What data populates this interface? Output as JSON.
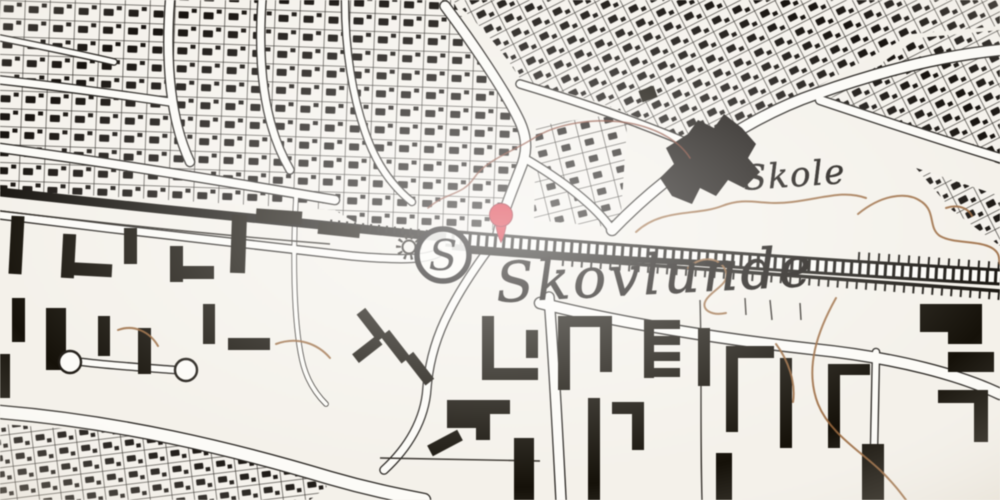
{
  "map": {
    "labels": {
      "place": "Skovlunde",
      "school": "Skole",
      "station": "S"
    },
    "marker": {
      "x": 500,
      "y": 216,
      "shape": "pin"
    },
    "station_symbol": {
      "x": 443,
      "y": 255
    },
    "colors": {
      "paper": "#f4f1ea",
      "ink": "#17130f",
      "road": "#fcfbf7",
      "contour": "#96673f",
      "contour_dark": "#7c3b2b",
      "marker_red": "#d1202e",
      "marker_edge": "#8c1420"
    }
  }
}
